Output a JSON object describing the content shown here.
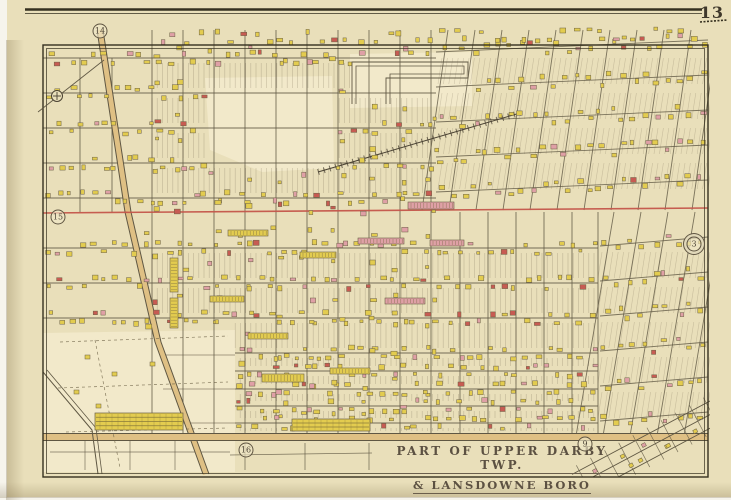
{
  "page": {
    "plate_number": "13",
    "title_line1": "PART OF UPPER DARBY TWP.",
    "title_line2": "& LANSDOWNE BORO"
  },
  "colors": {
    "paper": "#e9dfba",
    "paper_light": "#f2e9ca",
    "ink": "#4a4233",
    "street": "#5f5743",
    "building_yellow": "#e3cc4f",
    "building_pink": "#dfa0a6",
    "building_red": "#c75b52",
    "boundary_red": "#c4554a",
    "road_tint": "#dfc084",
    "border": "#35301f"
  },
  "markers": [
    {
      "label": "14",
      "x": 100,
      "y": 31
    },
    {
      "label": "15",
      "x": 58,
      "y": 217
    },
    {
      "label": "3",
      "x": 694,
      "y": 244,
      "double": true
    },
    {
      "label": "16",
      "x": 246,
      "y": 450
    },
    {
      "label": "9",
      "x": 585,
      "y": 444
    }
  ],
  "survey_marker": {
    "icon": "circle-cross-icon",
    "x": 57,
    "y": 96
  }
}
